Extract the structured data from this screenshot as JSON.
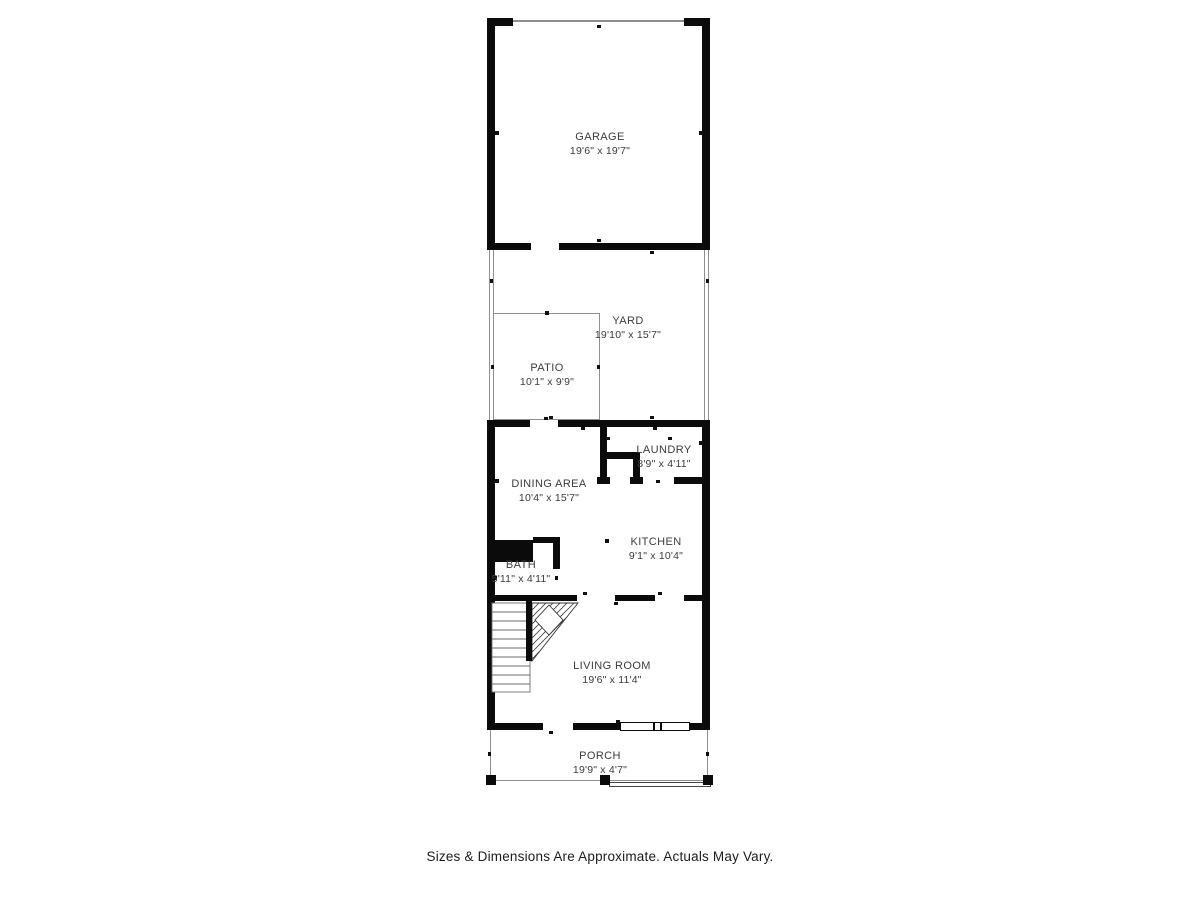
{
  "footer": {
    "text": "Sizes & Dimensions Are Approximate. Actuals May Vary."
  },
  "plan": {
    "wall_color": "#0b0b0b",
    "outdoor_line_color": "#8f8f8f",
    "label_color": "#3c3c3c",
    "rooms": [
      {
        "id": "garage",
        "name": "GARAGE",
        "dims": "19'6\" x 19'7\""
      },
      {
        "id": "yard",
        "name": "YARD",
        "dims": "19'10\" x 15'7\""
      },
      {
        "id": "patio",
        "name": "PATIO",
        "dims": "10'1\" x 9'9\""
      },
      {
        "id": "laundry",
        "name": "LAUNDRY",
        "dims": "8'9\" x 4'11\""
      },
      {
        "id": "dining_area",
        "name": "DINING AREA",
        "dims": "10'4\" x 15'7\""
      },
      {
        "id": "kitchen",
        "name": "KITCHEN",
        "dims": "9'1\" x 10'4\""
      },
      {
        "id": "bath",
        "name": "BATH",
        "dims": "5'11\" x 4'11\""
      },
      {
        "id": "living_room",
        "name": "LIVING ROOM",
        "dims": "19'6\" x 11'4\""
      },
      {
        "id": "porch",
        "name": "PORCH",
        "dims": "19'9\" x 4'7\""
      }
    ]
  }
}
